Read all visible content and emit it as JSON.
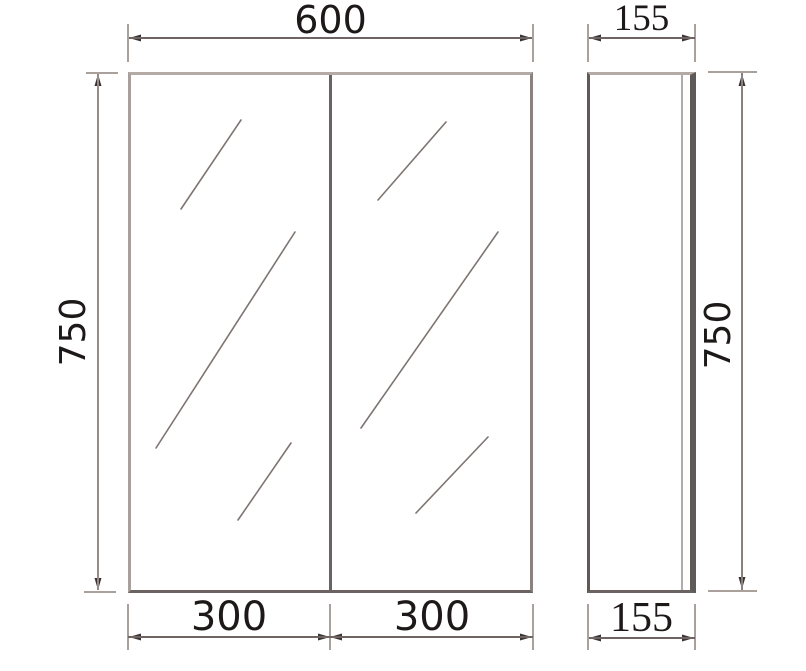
{
  "drawing": {
    "type": "technical-drawing",
    "subject": "double-door mirror cabinet, front and side orthographic views",
    "dims": {
      "front_width": "600",
      "front_height": "750",
      "left_door_width": "300",
      "right_door_width": "300",
      "side_depth_top": "155",
      "side_depth_bottom": "155",
      "side_height": "750"
    },
    "colors": {
      "background": "#ffffff",
      "outline_light": "#b4aba7",
      "outline_dark": "#5f5957",
      "divider": "#6b6361",
      "dimension_line": "#6e6562",
      "extension_line": "#aaa19d",
      "arrow": "#3a3534",
      "shine_line": "#7d7572",
      "text": "#1d1918"
    }
  }
}
